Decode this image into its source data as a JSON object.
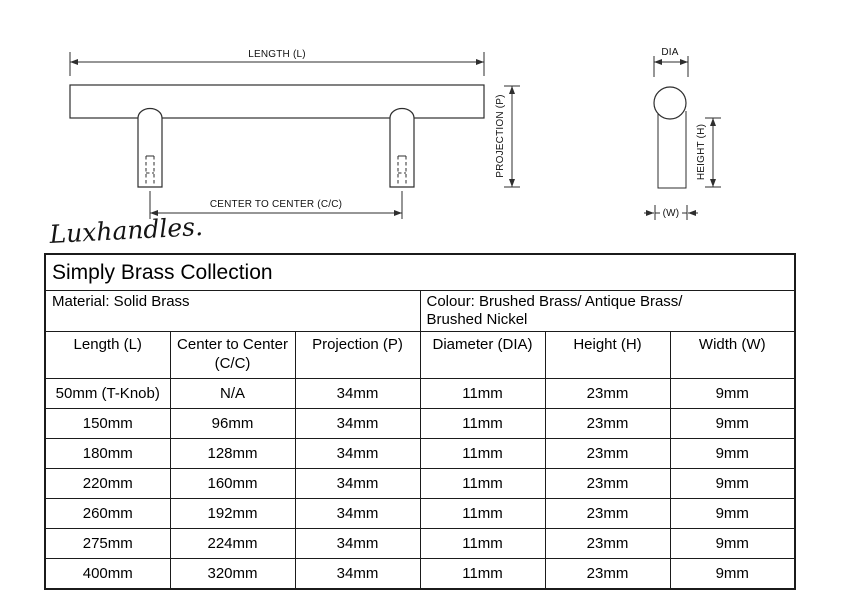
{
  "diagram": {
    "labels": {
      "length": "LENGTH (L)",
      "projection": "PROJECTION (P)",
      "center_to_center": "CENTER TO CENTER (C/C)",
      "dia": "DIA",
      "height": "HEIGHT (H)",
      "width": "(W)"
    },
    "line_color": "#2e2e2e"
  },
  "signature": {
    "text": "Luxhandles."
  },
  "table": {
    "title": "Simply Brass Collection",
    "material": "Material: Solid Brass",
    "colour": "Colour: Brushed Brass/ Antique Brass/\nBrushed Nickel",
    "columns": [
      "Length (L)",
      "Center to Center\n(C/C)",
      "Projection (P)",
      "Diameter (DIA)",
      "Height (H)",
      "Width (W)"
    ],
    "rows": [
      [
        "50mm (T-Knob)",
        "N/A",
        "34mm",
        "11mm",
        "23mm",
        "9mm"
      ],
      [
        "150mm",
        "96mm",
        "34mm",
        "11mm",
        "23mm",
        "9mm"
      ],
      [
        "180mm",
        "128mm",
        "34mm",
        "11mm",
        "23mm",
        "9mm"
      ],
      [
        "220mm",
        "160mm",
        "34mm",
        "11mm",
        "23mm",
        "9mm"
      ],
      [
        "260mm",
        "192mm",
        "34mm",
        "11mm",
        "23mm",
        "9mm"
      ],
      [
        "275mm",
        "224mm",
        "34mm",
        "11mm",
        "23mm",
        "9mm"
      ],
      [
        "400mm",
        "320mm",
        "34mm",
        "11mm",
        "23mm",
        "9mm"
      ]
    ]
  }
}
